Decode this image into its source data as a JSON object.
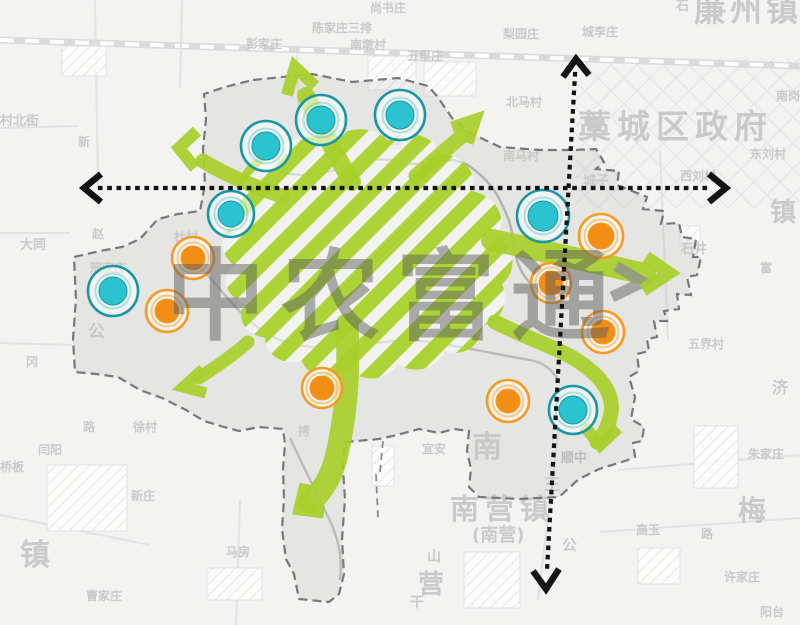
{
  "watermark": {
    "text": "中农富通"
  },
  "colors": {
    "green": "#a9cf2b",
    "cyan_fill": "#2cc3d1",
    "cyan_ring": "#1797a3",
    "orange_fill": "#f28d15",
    "orange_ring": "#f59b23",
    "orange_halo": "#f9c06e",
    "axis": "#141414",
    "boundary": "#787878",
    "watermark_gray": "#5f5f5f",
    "map_label_gray": "#c6c6c6"
  },
  "nodes": [
    {
      "c": "cyan",
      "x": 266,
      "y": 146,
      "ro": 25,
      "ri": 14
    },
    {
      "c": "cyan",
      "x": 321,
      "y": 120,
      "ro": 25,
      "ri": 14
    },
    {
      "c": "cyan",
      "x": 400,
      "y": 115,
      "ro": 25,
      "ri": 14
    },
    {
      "c": "cyan",
      "x": 231,
      "y": 214,
      "ro": 23,
      "ri": 13
    },
    {
      "c": "cyan",
      "x": 113,
      "y": 291,
      "ro": 25,
      "ri": 14
    },
    {
      "c": "cyan",
      "x": 543,
      "y": 216,
      "ro": 26,
      "ri": 15
    },
    {
      "c": "cyan",
      "x": 573,
      "y": 410,
      "ro": 24,
      "ri": 14
    },
    {
      "c": "orange",
      "x": 193,
      "y": 258,
      "ro": 21,
      "ri": 12
    },
    {
      "c": "orange",
      "x": 167,
      "y": 311,
      "ro": 21,
      "ri": 12
    },
    {
      "c": "orange",
      "x": 601,
      "y": 236,
      "ro": 22,
      "ri": 13
    },
    {
      "c": "orange",
      "x": 551,
      "y": 283,
      "ro": 20,
      "ri": 12
    },
    {
      "c": "orange",
      "x": 603,
      "y": 332,
      "ro": 21,
      "ri": 12
    },
    {
      "c": "orange",
      "x": 322,
      "y": 388,
      "ro": 20,
      "ri": 12
    },
    {
      "c": "orange",
      "x": 508,
      "y": 401,
      "ro": 21,
      "ri": 12
    }
  ],
  "map_labels": [
    {
      "t": "藁城区政府",
      "x": 578,
      "y": 110,
      "s": 33,
      "ls": 6
    },
    {
      "t": "廉州镇",
      "x": 694,
      "y": -6,
      "s": 32,
      "ls": 4
    },
    {
      "t": "南营镇",
      "x": 450,
      "y": 494,
      "s": 29,
      "ls": 6
    },
    {
      "t": "(南营)",
      "x": 472,
      "y": 527,
      "s": 18
    },
    {
      "t": "梅",
      "x": 738,
      "y": 496,
      "s": 28
    },
    {
      "t": "镇",
      "x": 770,
      "y": 200,
      "s": 26
    },
    {
      "t": "镇",
      "x": 20,
      "y": 540,
      "s": 30
    },
    {
      "t": "营",
      "x": 418,
      "y": 572,
      "s": 26
    },
    {
      "t": "南",
      "x": 472,
      "y": 432,
      "s": 30
    },
    {
      "t": "王",
      "x": 544,
      "y": 477,
      "s": 16
    },
    {
      "t": "济",
      "x": 772,
      "y": 380,
      "s": 16
    },
    {
      "t": "公",
      "x": 88,
      "y": 324,
      "s": 17
    },
    {
      "t": "公",
      "x": 562,
      "y": 538,
      "s": 15
    },
    {
      "t": "山",
      "x": 427,
      "y": 550,
      "s": 14
    },
    {
      "t": "干",
      "x": 410,
      "y": 596,
      "s": 14
    },
    {
      "t": "尚书庄",
      "x": 370,
      "y": 2,
      "s": 12
    },
    {
      "t": "陈家庄三排",
      "x": 312,
      "y": 22,
      "s": 12
    },
    {
      "t": "南墩村",
      "x": 350,
      "y": 39,
      "s": 12
    },
    {
      "t": "五里庄",
      "x": 407,
      "y": 50,
      "s": 12
    },
    {
      "t": "彭家庄",
      "x": 246,
      "y": 38,
      "s": 12
    },
    {
      "t": "村北街",
      "x": 0,
      "y": 115,
      "s": 13
    },
    {
      "t": "城李庄",
      "x": 582,
      "y": 26,
      "s": 12
    },
    {
      "t": "石",
      "x": 676,
      "y": 0,
      "s": 13
    },
    {
      "t": "梨园庄",
      "x": 503,
      "y": 28,
      "s": 12
    },
    {
      "t": "东刘村",
      "x": 750,
      "y": 148,
      "s": 12
    },
    {
      "t": "西刘村",
      "x": 680,
      "y": 170,
      "s": 12
    },
    {
      "t": "城子",
      "x": 583,
      "y": 175,
      "s": 13
    },
    {
      "t": "北马村",
      "x": 506,
      "y": 96,
      "s": 12
    },
    {
      "t": "南马村",
      "x": 503,
      "y": 150,
      "s": 12
    },
    {
      "t": "南岗",
      "x": 776,
      "y": 90,
      "s": 12
    },
    {
      "t": "石井",
      "x": 681,
      "y": 243,
      "s": 13
    },
    {
      "t": "富",
      "x": 760,
      "y": 262,
      "s": 12
    },
    {
      "t": "五界村",
      "x": 688,
      "y": 338,
      "s": 12
    },
    {
      "t": "朱家庄",
      "x": 748,
      "y": 448,
      "s": 12
    },
    {
      "t": "高玉",
      "x": 636,
      "y": 524,
      "s": 12
    },
    {
      "t": "路",
      "x": 701,
      "y": 528,
      "s": 12
    },
    {
      "t": "许家庄",
      "x": 724,
      "y": 571,
      "s": 12
    },
    {
      "t": "阳台",
      "x": 760,
      "y": 606,
      "s": 12
    },
    {
      "t": "顺中",
      "x": 561,
      "y": 452,
      "s": 13,
      "c": "#b8b8b8"
    },
    {
      "t": "宜安",
      "x": 422,
      "y": 443,
      "s": 12
    },
    {
      "t": "马房",
      "x": 226,
      "y": 546,
      "s": 12
    },
    {
      "t": "大同",
      "x": 20,
      "y": 239,
      "s": 13
    },
    {
      "t": "赵",
      "x": 92,
      "y": 228,
      "s": 12
    },
    {
      "t": "杜村",
      "x": 174,
      "y": 231,
      "s": 12
    },
    {
      "t": "邢家庄",
      "x": 90,
      "y": 262,
      "s": 12
    },
    {
      "t": "新",
      "x": 78,
      "y": 136,
      "s": 12
    },
    {
      "t": "徐村",
      "x": 133,
      "y": 421,
      "s": 12
    },
    {
      "t": "闫阳",
      "x": 38,
      "y": 444,
      "s": 12
    },
    {
      "t": "桥板",
      "x": 0,
      "y": 461,
      "s": 12
    },
    {
      "t": "新庄",
      "x": 131,
      "y": 490,
      "s": 12
    },
    {
      "t": "曹家庄",
      "x": 86,
      "y": 590,
      "s": 12
    },
    {
      "t": "路",
      "x": 83,
      "y": 421,
      "s": 12
    },
    {
      "t": "冈",
      "x": 26,
      "y": 356,
      "s": 12
    },
    {
      "t": "拷",
      "x": 298,
      "y": 425,
      "s": 12
    },
    {
      "t": "中颐",
      "x": 308,
      "y": 141,
      "s": 12
    },
    {
      "t": "市民",
      "x": 378,
      "y": 138,
      "s": 12
    }
  ]
}
